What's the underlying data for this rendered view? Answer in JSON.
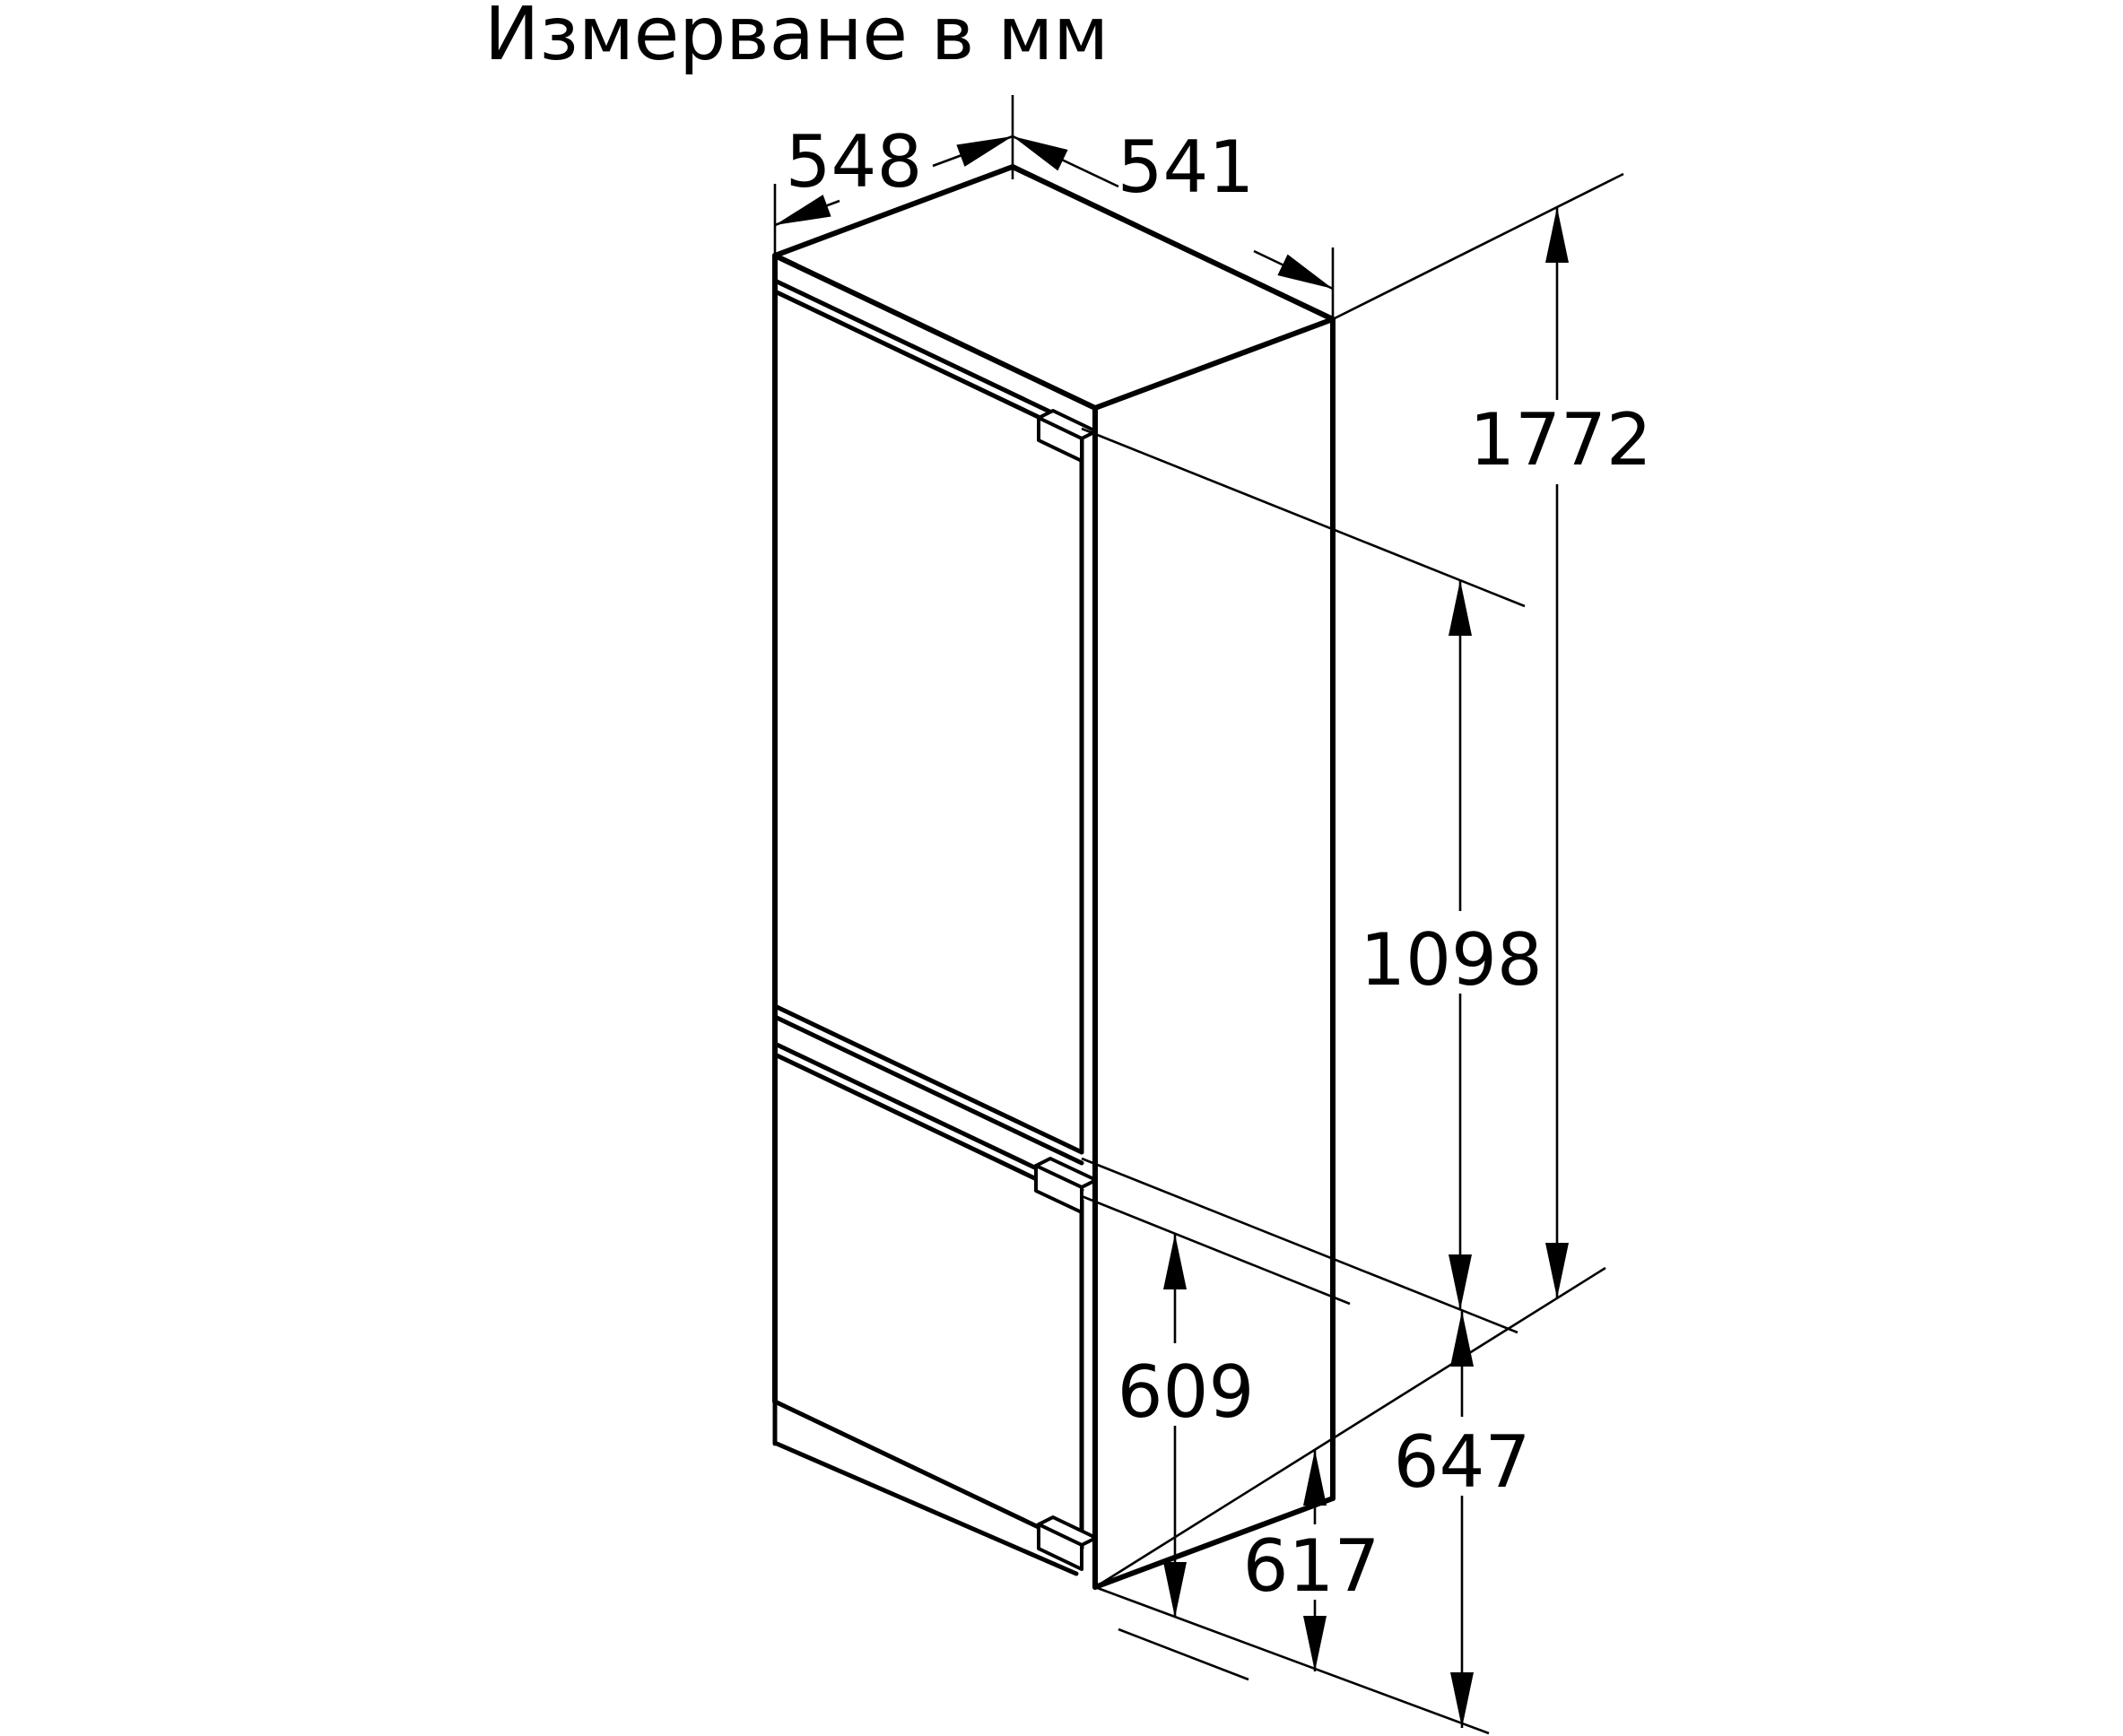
{
  "page": {
    "background": "#ffffff",
    "ink": "#000000"
  },
  "diagram": {
    "title": "Измерване в мм",
    "dimensions": {
      "depth_top": "548",
      "width_top": "541",
      "total_height": "1772",
      "upper_door_height": "1098",
      "lower_compartment_height": "609",
      "lower_niche_height": "647",
      "lower_door_height": "617"
    }
  }
}
